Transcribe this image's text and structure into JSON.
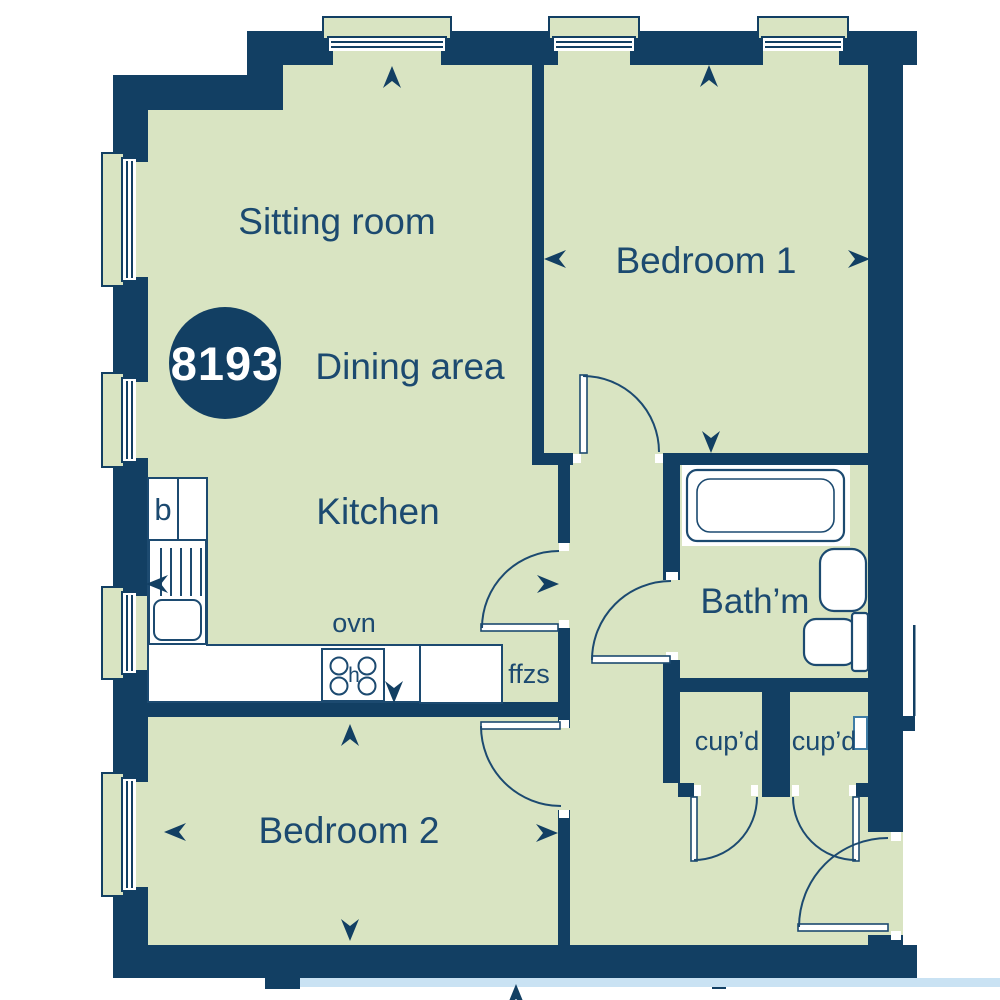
{
  "floorplan": {
    "unit_badge": "8193",
    "labels": {
      "sitting_room": "Sitting room",
      "dining_area": "Dining area",
      "kitchen": "Kitchen",
      "bedroom1": "Bedroom 1",
      "bedroom2": "Bedroom 2",
      "bathroom": "Bath’m",
      "cupboard_left": "cup’d",
      "cupboard_right": "cup’d",
      "oven": "ovn",
      "fridge_freezers": "ffzs",
      "boiler": "b",
      "hob": "h"
    },
    "colors": {
      "wall": "#123F63",
      "floor": "#D9E4C2",
      "outline": "#1C4A70",
      "pale_blue": "#C9E2F3",
      "fixture_fill": "#FFFFFF"
    }
  }
}
